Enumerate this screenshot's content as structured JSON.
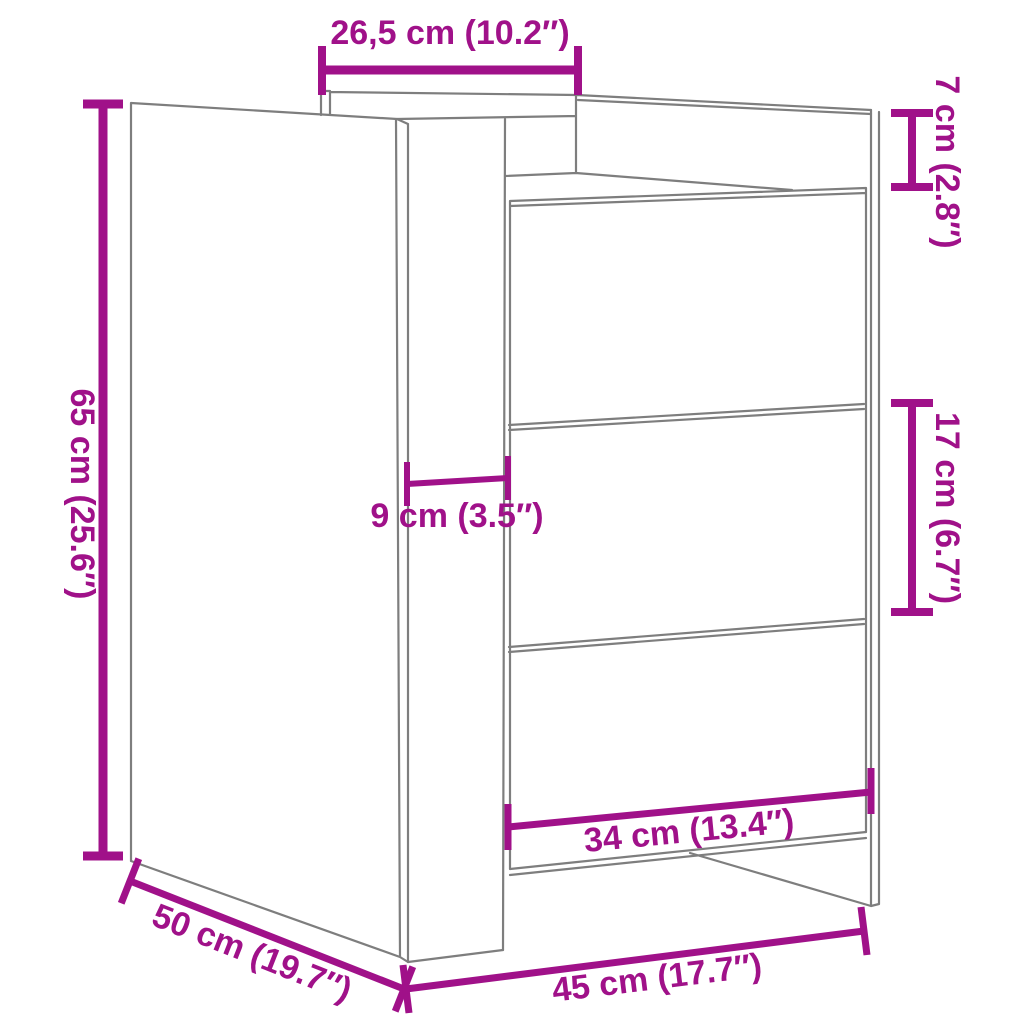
{
  "diagram": {
    "colors": {
      "accent": "#A01189",
      "outline": "#7E7E7E",
      "background": "#FFFFFF"
    },
    "dimensions": {
      "top_width": {
        "label": "26,5 cm (10.2″)"
      },
      "top_height": {
        "label": "7 cm (2.8″)"
      },
      "height": {
        "label": "65 cm (25.6″)"
      },
      "overhang": {
        "label": "9 cm (3.5″)"
      },
      "drawer_height": {
        "label": "17 cm (6.7″)"
      },
      "drawer_width": {
        "label": "34 cm (13.4″)"
      },
      "depth": {
        "label": "50 cm (19.7″)"
      },
      "width": {
        "label": "45 cm (17.7″)"
      }
    }
  }
}
